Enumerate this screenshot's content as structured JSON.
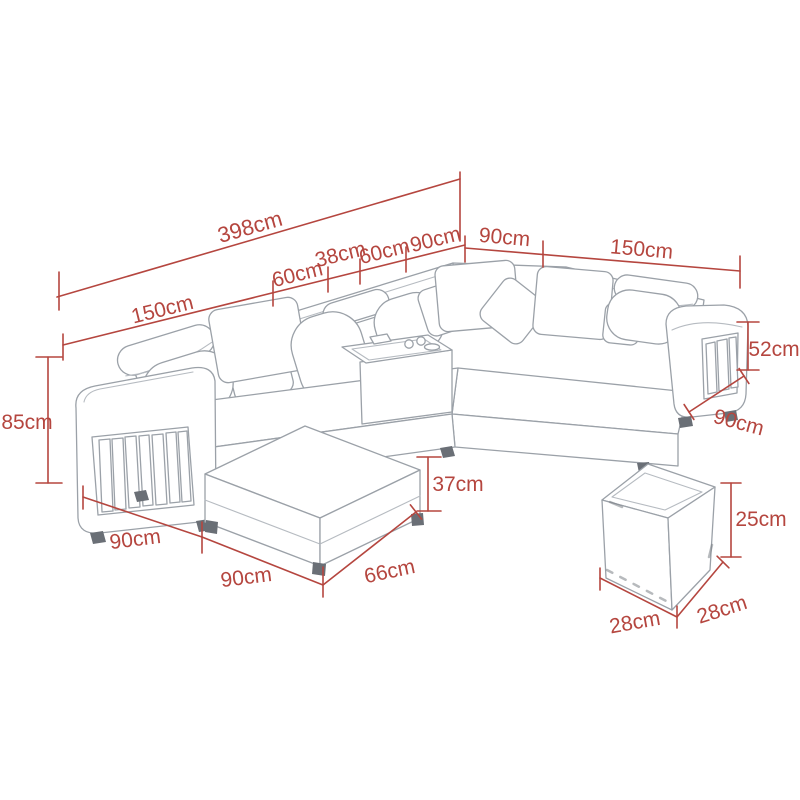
{
  "diagram": {
    "type": "furniture-dimension-diagram",
    "subject": "U-shaped sectional sofa with storage armrests, chaise lounge, console tray and cube ottoman",
    "unit": "cm",
    "accent_color": "#b5463f",
    "sketch_color": "#9ba1a8",
    "background_color": "#ffffff"
  },
  "dims": {
    "overall_length": "398cm",
    "top_left_segments": [
      "150cm",
      "60cm",
      "38cm",
      "60cm",
      "90cm"
    ],
    "top_right_segments": [
      "90cm",
      "150cm"
    ],
    "left_height": "85cm",
    "left_section_width": "90cm",
    "chaise_length": "90cm",
    "chaise_width": "66cm",
    "chaise_height": "37cm",
    "right_arm_height": "52cm",
    "right_section_depth": "90cm",
    "ottoman": {
      "height": "25cm",
      "width": "28cm",
      "depth": "28cm"
    }
  }
}
